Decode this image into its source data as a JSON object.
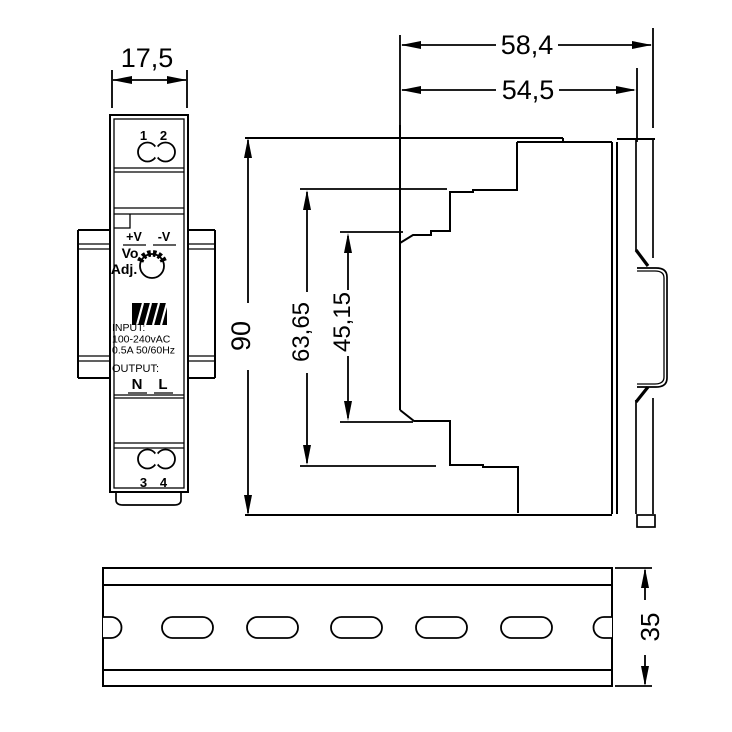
{
  "colors": {
    "line": "#000000",
    "background": "#ffffff"
  },
  "dimensions_mm": {
    "front_width": "17,5",
    "side_depth_total": "58,4",
    "side_depth_body": "54,5",
    "side_height_total": "90",
    "side_height_mid": "63,65",
    "side_height_front": "45,15",
    "rail_height": "35"
  },
  "views": {
    "front": {
      "terminal_top": {
        "label_1": "1",
        "label_2": "2"
      },
      "panel": {
        "plus_v": "+V",
        "minus_v": "-V",
        "vo": "Vo",
        "adj": "Adj.",
        "input_heading": "INPUT:",
        "input_voltage": "100-240vAC",
        "input_current": "0.5A 50/60Hz",
        "output_heading": "OUTPUT:",
        "neutral": "N",
        "line": "L"
      },
      "terminal_bottom": {
        "label_3": "3",
        "label_4": "4"
      },
      "logo_icon": "meanwell-logo"
    }
  }
}
